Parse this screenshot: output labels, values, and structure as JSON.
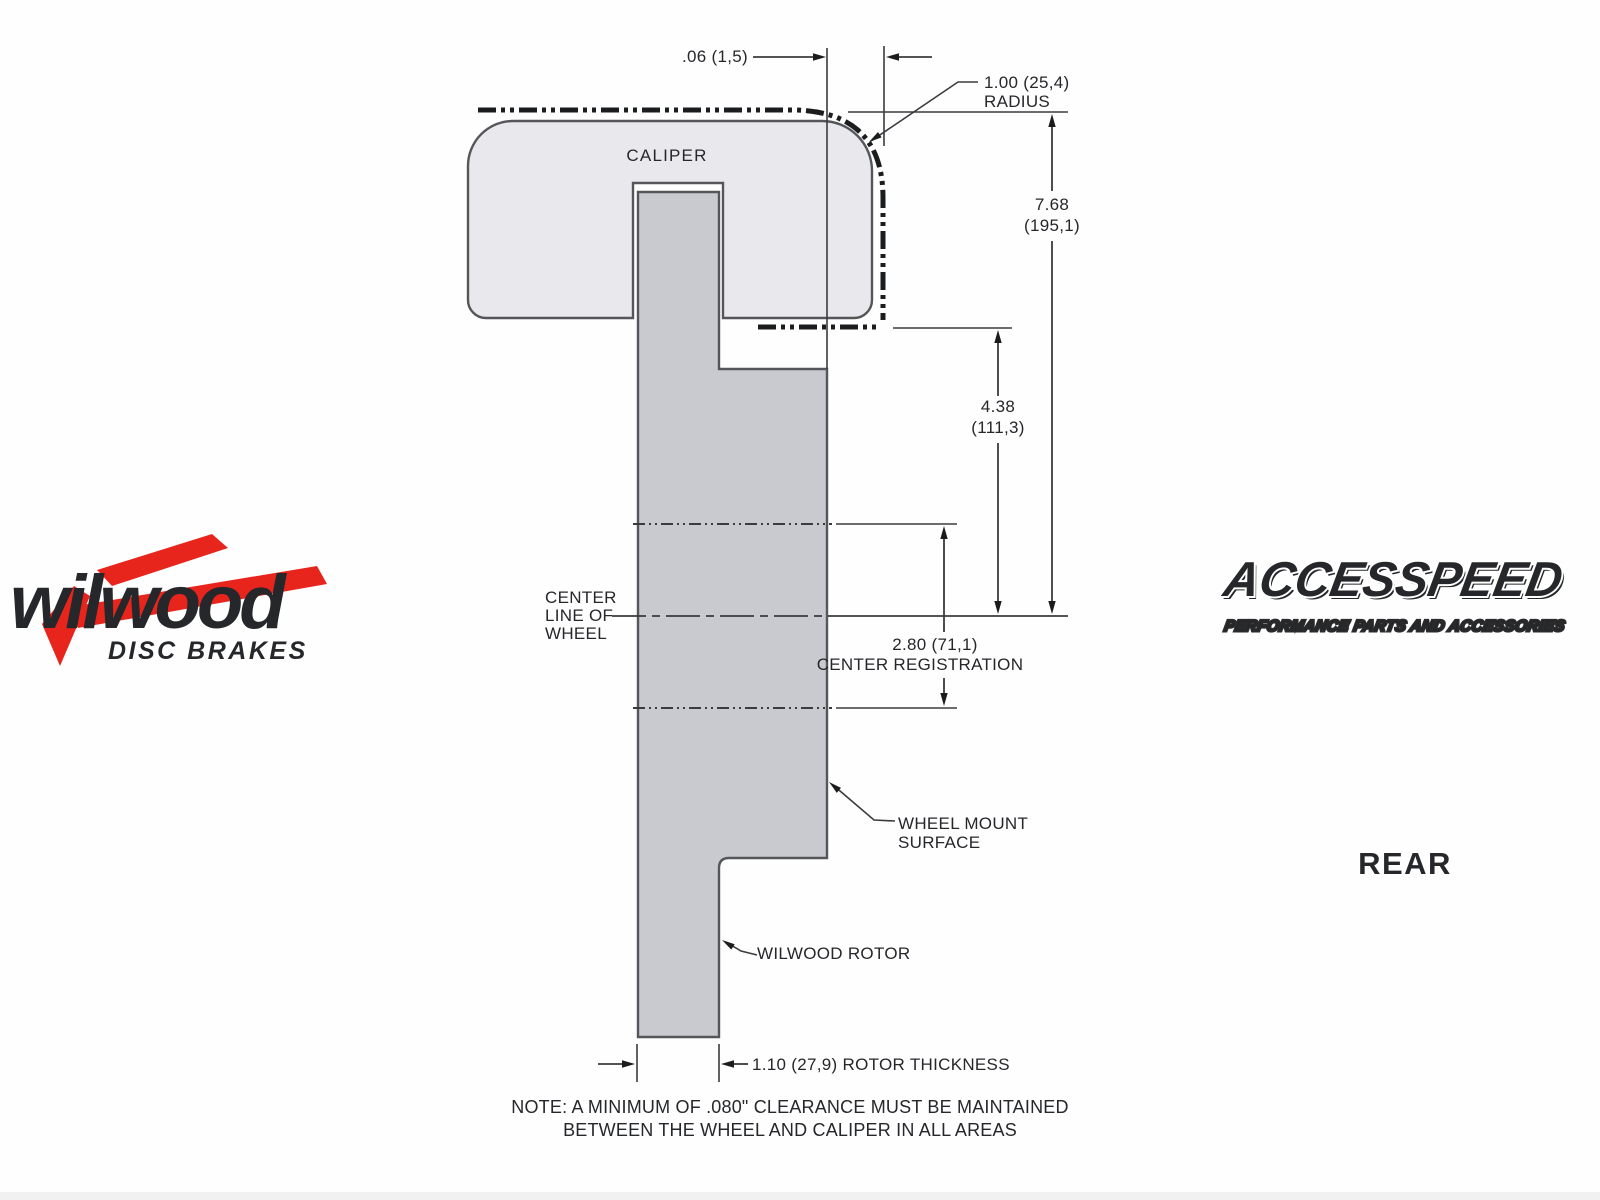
{
  "canvas": {
    "width": 1600,
    "height": 1200,
    "background": "#fefefe"
  },
  "colors": {
    "caliper_fill": "#e9e9ed",
    "rotor_fill": "#c9cad0",
    "line": "#3a3b3e",
    "brand_red": "#e8251d",
    "text": "#26272a"
  },
  "branding": {
    "wilwood": {
      "name": "wilwood",
      "tagline": "DISC BRAKES"
    },
    "accesspeed": {
      "name": "ACCESSPEED",
      "tagline": "PERFORMANCE PARTS AND ACCESSORIES"
    },
    "view_label": "REAR"
  },
  "diagram": {
    "caliper_label": "CALIPER",
    "labels": {
      "center_line": [
        "CENTER",
        "LINE OF",
        "WHEEL"
      ],
      "wheel_mount": [
        "WHEEL MOUNT",
        "SURFACE"
      ],
      "rotor_label": "WILWOOD ROTOR"
    },
    "dimensions": {
      "offset": ".06 (1,5)",
      "radius": [
        "1.00 (25,4)",
        "RADIUS"
      ],
      "overall_height": [
        "7.68",
        "(195,1)"
      ],
      "caliper_depth": [
        "4.38",
        "(111,3)"
      ],
      "center_registration": [
        "2.80 (71,1)",
        "CENTER REGISTRATION"
      ],
      "rotor_thickness": "1.10 (27,9) ROTOR THICKNESS"
    },
    "note": [
      "NOTE: A MINIMUM OF .080\" CLEARANCE MUST BE MAINTAINED",
      "BETWEEN THE WHEEL AND CALIPER IN ALL AREAS"
    ]
  }
}
